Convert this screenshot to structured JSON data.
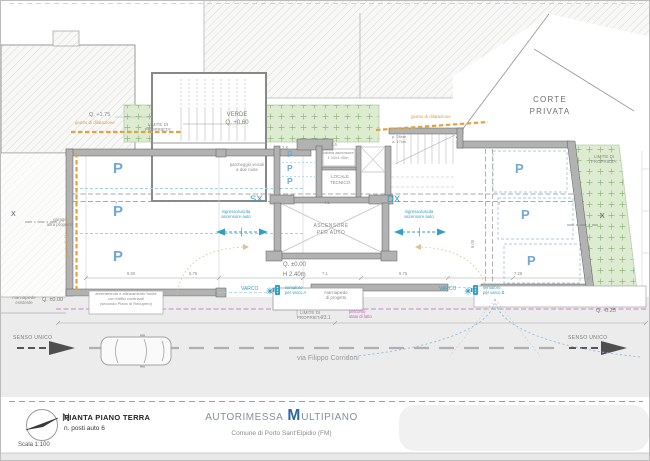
{
  "plan": {
    "corte_privata": [
      "CORTE",
      "PRIVATA"
    ],
    "verde": [
      "VERDE",
      "Q. +0.60"
    ],
    "limite_proprieta": [
      "LIMITE DI",
      "PROPRIETA'"
    ],
    "quota_esistente": "Q. +1.75",
    "giunto": "giunto di dilatazione",
    "parcheggio_due_ruote": [
      "parcheggio veicoli",
      "a due ruote"
    ],
    "cabina_ascensore": [
      "cabina ascensore",
      "1.10x1.40m"
    ],
    "locale_tecnico": [
      "LOCALE",
      "TECNICO"
    ],
    "gradini": [
      "p. 28cm",
      "a. 17cm"
    ],
    "lato_sx": "SX",
    "lato_dx": "DX",
    "ingresso_uscita": [
      "ingresso/uscita",
      "ascensore auto"
    ],
    "ascensore_auto": [
      "ASCENSORE",
      "PER AUTO"
    ],
    "quota_zero": "Q. ±0.00",
    "altezza_interna": "H 2.40m",
    "garage_confinante": [
      "garage",
      "altra proprietà"
    ],
    "section_marker": "X",
    "posto_auto": "P",
    "dims": {
      "d28": "2.8",
      "d26": "2.6",
      "d45": "4.5",
      "d7": "7",
      "d650": "6.50",
      "d575": "5.75",
      "d71": "7.1",
      "d675": "6.75",
      "d728": "7.28",
      "d600": "6.00"
    }
  },
  "street": {
    "marciapiede_esistente": [
      "marciapiede",
      "esistente"
    ],
    "quota_marciapiede": "Q. ±0.00",
    "arretramento": [
      "arretramento e allineamento fronte",
      "con edifici confinanti",
      "(secondo Piano di Recupero)"
    ],
    "varco": "VARCO",
    "semaforo_a": [
      "semaforo",
      "per varco A"
    ],
    "semaforo_b": [
      "semaforo",
      "per varco B"
    ],
    "marciapiede_progetto": [
      "marciapiede",
      "di progetto"
    ],
    "limite_proprieta": [
      "LIMITE DI",
      "PROPRIETA'"
    ],
    "percorso_esistente": [
      "percorso",
      "stato di fatto"
    ],
    "quota_strada": "Q. -0.25",
    "senso_unico": "SENSO UNICO",
    "via": "via Filippo Corridoni",
    "dim_fronte": "23.1"
  },
  "title_block": {
    "north": "N",
    "scale": "Scala 1:100",
    "drawing_title": "PIANTA PIANO TERRA",
    "drawing_subtitle": "n. posti auto 6",
    "project_title_part1": "AUTORIMESSA",
    "project_title_initial": "M",
    "project_title_part2": "ULTIPIANO",
    "municipality": "Comune di Porto Sant'Elpidio (FM)"
  }
}
